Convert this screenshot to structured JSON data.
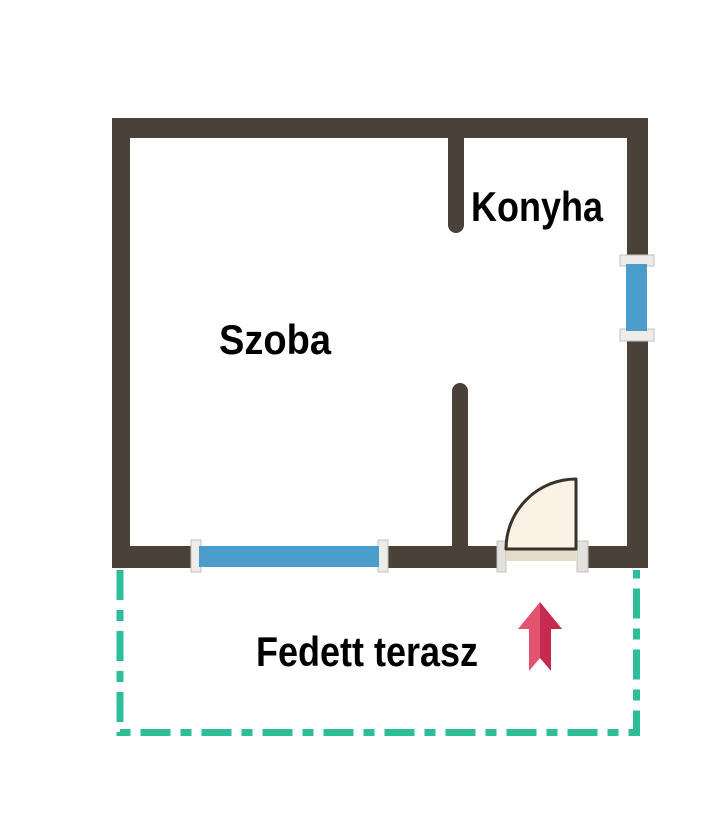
{
  "floorplan": {
    "labels": {
      "room": "Szoba",
      "kitchen": "Konyha",
      "terrace": "Fedett terasz"
    },
    "colors": {
      "wall": "#4a4139",
      "window_glass": "#4a9cca",
      "window_frame": "#edece9",
      "window_frame_edge": "#c2c0bc",
      "door_swing_fill": "#faf2e5",
      "door_leaf": "#e4dbc9",
      "door_outline": "#39322b",
      "door_opening": "#ffffff",
      "jamb": "#e3e1dd",
      "terrace_outline": "#2dbd98",
      "arrow_light": "#e1536f",
      "arrow_dark": "#c62a4f",
      "label_text": "#000000",
      "background": "#ffffff"
    },
    "icons": [
      {
        "name": "entrance-arrow-icon",
        "meaning": "entrance direction pointing up into the house",
        "glyph": "↑"
      }
    ]
  }
}
